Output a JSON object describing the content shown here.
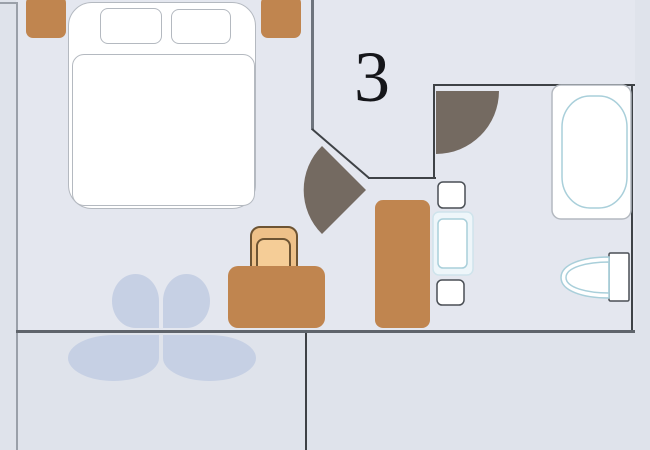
{
  "floor_plan": {
    "unit_label": "3",
    "palette": {
      "interior_background": "#e4e7ef",
      "exterior_background": "#dfe3eb",
      "wall_dark": "#3e4246",
      "wall_medium": "#6e747d",
      "wall_light": "#9aa0a9",
      "wall_bottom": "#5f646b",
      "furniture_wood": "#c0854f",
      "chair_tan": "#eec189",
      "door_leaf_taupe": "#746a61",
      "fixture_cyan_outline": "#a9cfda",
      "linen_white": "#ffffff",
      "decor_leaf_blue": "#c6d0e4"
    },
    "objects": [
      "double-bed",
      "pillow-left",
      "pillow-right",
      "nightstand-left",
      "nightstand-right",
      "desk",
      "chair",
      "wardrobe",
      "room-door-swing",
      "bathroom-door-swing",
      "bathtub",
      "washbasin",
      "toilet",
      "bathroom-shelf-top",
      "bathroom-shelf-bottom",
      "decorative-leaves"
    ]
  }
}
